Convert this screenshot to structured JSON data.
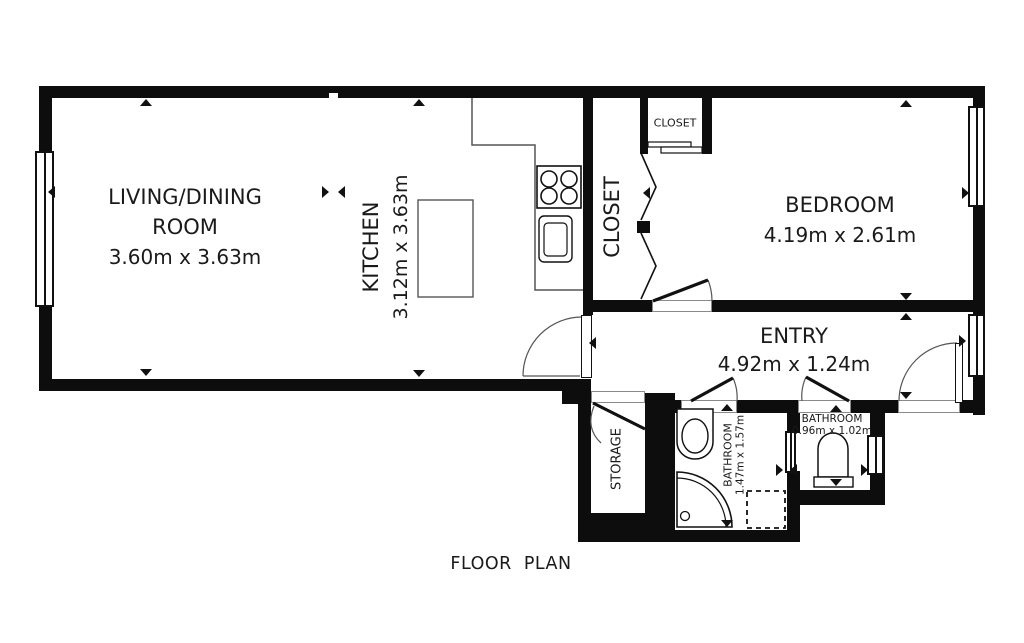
{
  "title": "FLOOR PLAN",
  "rooms": {
    "living": {
      "line1": "LIVING/DINING",
      "line2": "ROOM",
      "dims": "3.60m x 3.63m"
    },
    "kitchen": {
      "name": "KITCHEN",
      "dims": "3.12m x 3.63m"
    },
    "closet_main": {
      "name": "CLOSET"
    },
    "closet_small": {
      "name": "CLOSET"
    },
    "bedroom": {
      "name": "BEDROOM",
      "dims": "4.19m x 2.61m"
    },
    "entry": {
      "name": "ENTRY",
      "dims": "4.92m x 1.24m"
    },
    "storage": {
      "name": "STORAGE"
    },
    "bathroom_main": {
      "name": "BATHROOM",
      "dims": "1.47m x 1.57m"
    },
    "bathroom_small": {
      "name": "BATHROOM",
      "dims": "0.96m x 1.02m"
    }
  },
  "colors": {
    "wall": "#0d0d0d",
    "line": "#555555",
    "text": "#1a1a1a",
    "background": "#ffffff"
  }
}
